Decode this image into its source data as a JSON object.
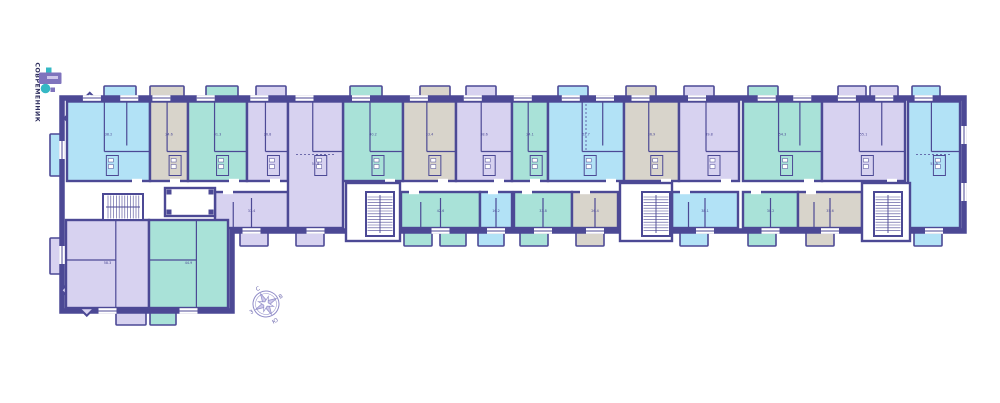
{
  "palette": {
    "wall": "#4c4995",
    "cyan": "#b2e2f6",
    "teal": "#a9e2d8",
    "lavender": "#d7d2f0",
    "gray": "#d8d4cb",
    "white": "#ffffff",
    "logoTeal": "#35b8c4",
    "logoPurple": "#7f73bd",
    "logoText": "#2d2d5c",
    "compassStroke": "#8f8bc7",
    "compassFill": "#cdc8ea",
    "compassText": "#6b66ad"
  },
  "logo": {
    "name": "СОВРЕМЕННИК",
    "tagline": "··························"
  },
  "compass": {
    "n": "С",
    "e": "В",
    "s": "Ю",
    "w": "З",
    "rotation": -28
  },
  "plan": {
    "units_top": [
      {
        "x": 67,
        "w": 83,
        "c": "cyan",
        "a": "38.2",
        "bay": "tl"
      },
      {
        "x": 150,
        "w": 38,
        "c": "gray",
        "a": "24.6"
      },
      {
        "x": 188,
        "w": 59,
        "c": "teal",
        "a": "41.3"
      },
      {
        "x": 247,
        "w": 41,
        "c": "lavender",
        "a": "26.8"
      },
      {
        "x": 343,
        "w": 60,
        "c": "teal",
        "a": "40.2"
      },
      {
        "x": 403,
        "w": 53,
        "c": "gray",
        "a": "33.4"
      },
      {
        "x": 456,
        "w": 56,
        "c": "lavender",
        "a": "38.6"
      },
      {
        "x": 512,
        "w": 36,
        "c": "teal",
        "a": "24.1"
      },
      {
        "x": 548,
        "w": 76,
        "c": "cyan",
        "a": "52.7"
      },
      {
        "x": 624,
        "w": 55,
        "c": "gray",
        "a": "36.9"
      },
      {
        "x": 679,
        "w": 60,
        "c": "lavender",
        "a": "39.8"
      },
      {
        "x": 743,
        "w": 79,
        "c": "teal",
        "a": "54.3"
      },
      {
        "x": 822,
        "w": 83,
        "c": "lavender",
        "a": "55.1"
      }
    ],
    "units_full": [
      {
        "x": 288,
        "w": 55,
        "c": "lavender",
        "a": "51.8"
      },
      {
        "x": 908,
        "w": 52,
        "c": "cyan",
        "a": "53.9"
      }
    ],
    "units_bottom": [
      {
        "x": 215,
        "w": 73,
        "c": "lavender",
        "a": "37.4"
      },
      {
        "x": 401,
        "w": 79,
        "c": "teal",
        "a": "42.6"
      },
      {
        "x": 480,
        "w": 32,
        "c": "cyan",
        "a": "16.2"
      },
      {
        "x": 514,
        "w": 58,
        "c": "teal",
        "a": "33.8"
      },
      {
        "x": 572,
        "w": 46,
        "c": "gray",
        "a": "26.4"
      },
      {
        "x": 672,
        "w": 66,
        "c": "cyan",
        "a": "38.1"
      },
      {
        "x": 743,
        "w": 55,
        "c": "teal",
        "a": "30.2"
      },
      {
        "x": 798,
        "w": 64,
        "c": "gray",
        "a": "35.6"
      }
    ],
    "units_wing": [
      {
        "x": 66,
        "w": 83,
        "c": "lavender",
        "a": "58.3",
        "bay": "bl"
      },
      {
        "x": 149,
        "w": 79,
        "c": "teal",
        "a": "44.9"
      }
    ],
    "balconies": [
      {
        "x": 104,
        "y": 86,
        "w": 32,
        "h": 14,
        "c": "cyan"
      },
      {
        "x": 150,
        "y": 86,
        "w": 34,
        "h": 14,
        "c": "gray"
      },
      {
        "x": 206,
        "y": 86,
        "w": 32,
        "h": 14,
        "c": "teal"
      },
      {
        "x": 256,
        "y": 86,
        "w": 30,
        "h": 14,
        "c": "lavender"
      },
      {
        "x": 350,
        "y": 86,
        "w": 32,
        "h": 14,
        "c": "teal"
      },
      {
        "x": 420,
        "y": 86,
        "w": 30,
        "h": 14,
        "c": "gray"
      },
      {
        "x": 466,
        "y": 86,
        "w": 30,
        "h": 14,
        "c": "lavender"
      },
      {
        "x": 558,
        "y": 86,
        "w": 30,
        "h": 14,
        "c": "cyan"
      },
      {
        "x": 626,
        "y": 86,
        "w": 30,
        "h": 14,
        "c": "gray"
      },
      {
        "x": 684,
        "y": 86,
        "w": 30,
        "h": 14,
        "c": "lavender"
      },
      {
        "x": 748,
        "y": 86,
        "w": 30,
        "h": 14,
        "c": "teal"
      },
      {
        "x": 838,
        "y": 86,
        "w": 28,
        "h": 14,
        "c": "lavender"
      },
      {
        "x": 870,
        "y": 86,
        "w": 28,
        "h": 14,
        "c": "lavender"
      },
      {
        "x": 912,
        "y": 86,
        "w": 28,
        "h": 14,
        "c": "cyan"
      },
      {
        "x": 240,
        "y": 230,
        "w": 28,
        "h": 16,
        "c": "lavender"
      },
      {
        "x": 296,
        "y": 230,
        "w": 28,
        "h": 16,
        "c": "lavender"
      },
      {
        "x": 404,
        "y": 230,
        "w": 28,
        "h": 16,
        "c": "teal"
      },
      {
        "x": 440,
        "y": 230,
        "w": 26,
        "h": 16,
        "c": "teal"
      },
      {
        "x": 478,
        "y": 230,
        "w": 26,
        "h": 16,
        "c": "cyan"
      },
      {
        "x": 520,
        "y": 230,
        "w": 28,
        "h": 16,
        "c": "teal"
      },
      {
        "x": 576,
        "y": 230,
        "w": 28,
        "h": 16,
        "c": "gray"
      },
      {
        "x": 680,
        "y": 230,
        "w": 28,
        "h": 16,
        "c": "cyan"
      },
      {
        "x": 748,
        "y": 230,
        "w": 28,
        "h": 16,
        "c": "teal"
      },
      {
        "x": 806,
        "y": 230,
        "w": 28,
        "h": 16,
        "c": "gray"
      },
      {
        "x": 914,
        "y": 230,
        "w": 28,
        "h": 16,
        "c": "cyan"
      },
      {
        "x": 116,
        "y": 309,
        "w": 30,
        "h": 16,
        "c": "lavender"
      },
      {
        "x": 150,
        "y": 309,
        "w": 26,
        "h": 16,
        "c": "teal"
      },
      {
        "x": 50,
        "y": 134,
        "w": 13,
        "h": 42,
        "c": "cyan"
      },
      {
        "x": 50,
        "y": 238,
        "w": 13,
        "h": 36,
        "c": "lavender"
      }
    ],
    "lobbies": [
      {
        "x": 346,
        "y": 183,
        "w": 54,
        "h": 58
      },
      {
        "x": 620,
        "y": 183,
        "w": 52,
        "h": 58
      },
      {
        "x": 862,
        "y": 183,
        "w": 48,
        "h": 58
      }
    ],
    "vestibule": {
      "x": 165,
      "y": 188,
      "w": 50,
      "h": 28
    },
    "stairs": [
      {
        "x": 103,
        "y": 194,
        "w": 40,
        "h": 26,
        "dir": "h"
      },
      {
        "x": 366,
        "y": 192,
        "w": 28,
        "h": 44,
        "dir": "v"
      },
      {
        "x": 642,
        "y": 192,
        "w": 28,
        "h": 44,
        "dir": "v"
      },
      {
        "x": 874,
        "y": 192,
        "w": 28,
        "h": 44,
        "dir": "v"
      }
    ],
    "windows_side": [
      {
        "x": 62,
        "y": 150
      },
      {
        "x": 62,
        "y": 255
      },
      {
        "x": 964,
        "y": 135
      },
      {
        "x": 964,
        "y": 192
      }
    ]
  }
}
